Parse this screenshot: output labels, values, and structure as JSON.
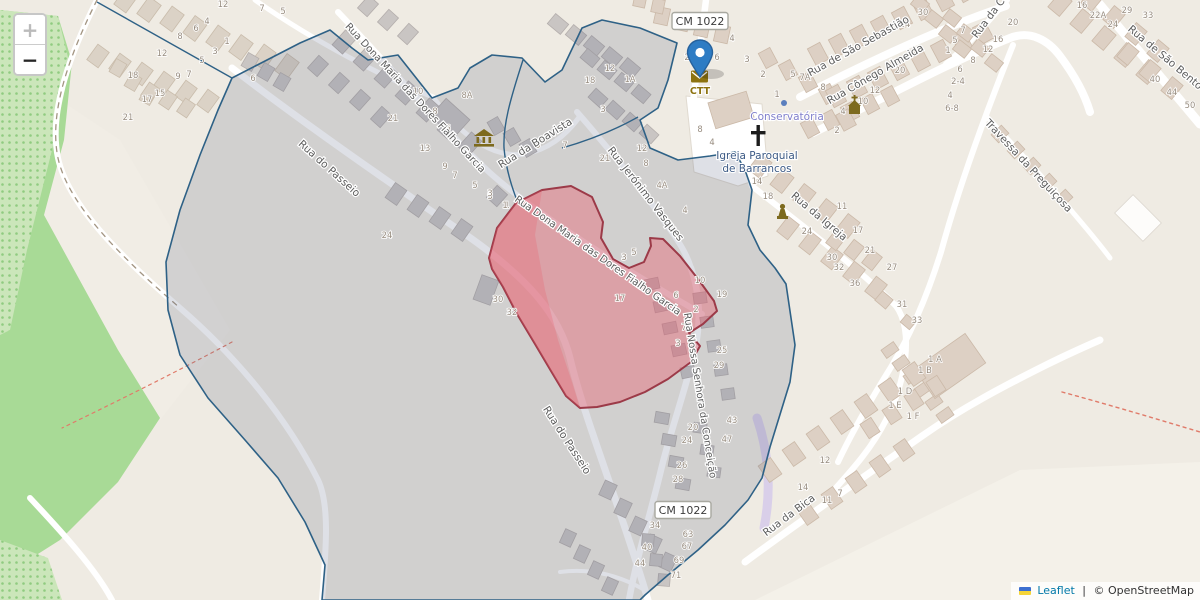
{
  "map_app": {
    "controls": {
      "zoom_in_label": "+",
      "zoom_out_label": "−"
    },
    "attribution": {
      "flag_icon": "ukraine-flag-icon",
      "leaflet_link": "Leaflet",
      "separator": " | ",
      "osm_credit": "© OpenStreetMap"
    },
    "marker": {
      "color": "#2e7cc4",
      "outline": "#26619c"
    },
    "overlay_colors": {
      "boundary_stroke": "#2e6186",
      "boundary_fill": "rgba(88,102,132,0.20)",
      "highlight_stroke": "#9c3a48",
      "highlight_fill": "rgba(233,96,112,0.42)"
    },
    "road_badges": [
      {
        "text": "CM 1022",
        "x": 700,
        "y": 21
      },
      {
        "text": "CM 1022",
        "x": 683,
        "y": 510
      }
    ],
    "pois": {
      "post_office": {
        "label": "CTT",
        "color": "#8d7310"
      },
      "conservatoria": {
        "label": "Conservatória",
        "color": "#8180cb"
      },
      "parish_church": {
        "label_line1": "Igreja Paroquial",
        "label_line2": "de Barrancos",
        "color": "#3c5a85"
      },
      "museum": {
        "icon": "museum-icon"
      },
      "chapel": {
        "icon": "chapel-icon"
      },
      "memorial": {
        "icon": "memorial-icon"
      }
    },
    "street_labels": [
      {
        "text": "Rua do Passeio",
        "x": 327,
        "y": 171,
        "rot": 42
      },
      {
        "text": "Rua do Passeio",
        "x": 564,
        "y": 442,
        "rot": 57
      },
      {
        "text": "Rua Dona Maria das Dores Fialho Garcia",
        "x": 413,
        "y": 100,
        "rot": 47,
        "fs": 10
      },
      {
        "text": "Rua Dona Maria das Dores Fialho Garcia",
        "x": 596,
        "y": 258,
        "rot": 35,
        "fs": 10
      },
      {
        "text": "Rua da Boavista",
        "x": 537,
        "y": 146,
        "rot": -32
      },
      {
        "text": "Rua Jerónimo Vasques",
        "x": 643,
        "y": 196,
        "rot": 52
      },
      {
        "text": "Rua Nossa Senhora da Conceição",
        "x": 697,
        "y": 396,
        "rot": 81,
        "fs": 10
      },
      {
        "text": "Rua de São Sebastião",
        "x": 860,
        "y": 49,
        "rot": -29
      },
      {
        "text": "Rua Cônego Almeida",
        "x": 877,
        "y": 77,
        "rot": -30
      },
      {
        "text": "Rua da Igreja",
        "x": 817,
        "y": 219,
        "rot": 40
      },
      {
        "text": "Travessa da Preguiçosa",
        "x": 1026,
        "y": 168,
        "rot": 47
      },
      {
        "text": "Rua de São Bento",
        "x": 1163,
        "y": 60,
        "rot": 40
      },
      {
        "text": "Rua da C",
        "x": 991,
        "y": 20,
        "rot": -53
      },
      {
        "text": "Rua da Bica",
        "x": 791,
        "y": 518,
        "rot": -37
      }
    ],
    "house_numbers": [
      {
        "t": "12",
        "x": 223,
        "y": 7
      },
      {
        "t": "7",
        "x": 262,
        "y": 11
      },
      {
        "t": "5",
        "x": 283,
        "y": 14
      },
      {
        "t": "4",
        "x": 207,
        "y": 24
      },
      {
        "t": "6",
        "x": 196,
        "y": 31
      },
      {
        "t": "8",
        "x": 180,
        "y": 39
      },
      {
        "t": "1",
        "x": 227,
        "y": 44
      },
      {
        "t": "3",
        "x": 215,
        "y": 54
      },
      {
        "t": "12",
        "x": 162,
        "y": 56
      },
      {
        "t": "5",
        "x": 202,
        "y": 63
      },
      {
        "t": "18",
        "x": 133,
        "y": 78
      },
      {
        "t": "9",
        "x": 178,
        "y": 79
      },
      {
        "t": "7",
        "x": 189,
        "y": 77
      },
      {
        "t": "17",
        "x": 147,
        "y": 102
      },
      {
        "t": "15",
        "x": 160,
        "y": 96
      },
      {
        "t": "21",
        "x": 128,
        "y": 120
      },
      {
        "t": "6",
        "x": 253,
        "y": 81
      },
      {
        "t": "24",
        "x": 387,
        "y": 238
      },
      {
        "t": "10",
        "x": 418,
        "y": 94
      },
      {
        "t": "8A",
        "x": 467,
        "y": 98
      },
      {
        "t": "8",
        "x": 435,
        "y": 114
      },
      {
        "t": "6",
        "x": 448,
        "y": 131
      },
      {
        "t": "21",
        "x": 393,
        "y": 121
      },
      {
        "t": "13",
        "x": 425,
        "y": 151
      },
      {
        "t": "9",
        "x": 445,
        "y": 169
      },
      {
        "t": "7",
        "x": 455,
        "y": 178
      },
      {
        "t": "5",
        "x": 475,
        "y": 188
      },
      {
        "t": "3",
        "x": 490,
        "y": 199
      },
      {
        "t": "1",
        "x": 507,
        "y": 208
      },
      {
        "t": "18",
        "x": 590,
        "y": 83
      },
      {
        "t": "9",
        "x": 538,
        "y": 148
      },
      {
        "t": "7",
        "x": 565,
        "y": 148
      },
      {
        "t": "12",
        "x": 610,
        "y": 71
      },
      {
        "t": "1A",
        "x": 630,
        "y": 82
      },
      {
        "t": "3",
        "x": 603,
        "y": 112
      },
      {
        "t": "21",
        "x": 605,
        "y": 161
      },
      {
        "t": "12",
        "x": 642,
        "y": 151
      },
      {
        "t": "8",
        "x": 646,
        "y": 166
      },
      {
        "t": "4A",
        "x": 662,
        "y": 188
      },
      {
        "t": "8",
        "x": 700,
        "y": 132
      },
      {
        "t": "4",
        "x": 712,
        "y": 145
      },
      {
        "t": "4",
        "x": 685,
        "y": 213
      },
      {
        "t": "2",
        "x": 687,
        "y": 60
      },
      {
        "t": "6",
        "x": 717,
        "y": 60
      },
      {
        "t": "4",
        "x": 732,
        "y": 41
      },
      {
        "t": "3",
        "x": 747,
        "y": 62
      },
      {
        "t": "2",
        "x": 763,
        "y": 77
      },
      {
        "t": "1",
        "x": 777,
        "y": 97
      },
      {
        "t": "5",
        "x": 793,
        "y": 77
      },
      {
        "t": "7A",
        "x": 805,
        "y": 80
      },
      {
        "t": "10",
        "x": 863,
        "y": 104
      },
      {
        "t": "4",
        "x": 843,
        "y": 114
      },
      {
        "t": "2",
        "x": 837,
        "y": 133
      },
      {
        "t": "11",
        "x": 842,
        "y": 209
      },
      {
        "t": "14",
        "x": 757,
        "y": 184
      },
      {
        "t": "18",
        "x": 768,
        "y": 199
      },
      {
        "t": "24",
        "x": 807,
        "y": 234
      },
      {
        "t": "24",
        "x": 905,
        "y": 27
      },
      {
        "t": "7",
        "x": 963,
        "y": 33
      },
      {
        "t": "5",
        "x": 955,
        "y": 43
      },
      {
        "t": "12",
        "x": 988,
        "y": 52
      },
      {
        "t": "8",
        "x": 973,
        "y": 63
      },
      {
        "t": "20",
        "x": 900,
        "y": 73
      },
      {
        "t": "12",
        "x": 875,
        "y": 93
      },
      {
        "t": "8",
        "x": 823,
        "y": 90
      },
      {
        "t": "6",
        "x": 960,
        "y": 72
      },
      {
        "t": "2-4",
        "x": 958,
        "y": 84
      },
      {
        "t": "4",
        "x": 950,
        "y": 98
      },
      {
        "t": "6-8",
        "x": 952,
        "y": 111
      },
      {
        "t": "30",
        "x": 923,
        "y": 15
      },
      {
        "t": "1",
        "x": 948,
        "y": 53
      },
      {
        "t": "20",
        "x": 1013,
        "y": 25
      },
      {
        "t": "16",
        "x": 998,
        "y": 42
      },
      {
        "t": "16",
        "x": 1082,
        "y": 8
      },
      {
        "t": "22A",
        "x": 1098,
        "y": 18
      },
      {
        "t": "29",
        "x": 1127,
        "y": 13
      },
      {
        "t": "24",
        "x": 1113,
        "y": 27
      },
      {
        "t": "33",
        "x": 1148,
        "y": 18
      },
      {
        "t": "40",
        "x": 1155,
        "y": 82
      },
      {
        "t": "44",
        "x": 1172,
        "y": 95
      },
      {
        "t": "50",
        "x": 1190,
        "y": 108
      },
      {
        "t": "17",
        "x": 858,
        "y": 233
      },
      {
        "t": "21",
        "x": 870,
        "y": 253
      },
      {
        "t": "30",
        "x": 832,
        "y": 260
      },
      {
        "t": "32",
        "x": 839,
        "y": 270
      },
      {
        "t": "27",
        "x": 892,
        "y": 270
      },
      {
        "t": "36",
        "x": 855,
        "y": 286
      },
      {
        "t": "31",
        "x": 902,
        "y": 307
      },
      {
        "t": "33",
        "x": 917,
        "y": 323
      },
      {
        "t": "1 A",
        "x": 935,
        "y": 362
      },
      {
        "t": "1 B",
        "x": 925,
        "y": 373
      },
      {
        "t": "1 D",
        "x": 905,
        "y": 394
      },
      {
        "t": "1 E",
        "x": 895,
        "y": 408
      },
      {
        "t": "1 F",
        "x": 913,
        "y": 419
      },
      {
        "t": "3",
        "x": 490,
        "y": 196
      },
      {
        "t": "1",
        "x": 505,
        "y": 208
      },
      {
        "t": "3",
        "x": 624,
        "y": 260
      },
      {
        "t": "5",
        "x": 634,
        "y": 255
      },
      {
        "t": "17",
        "x": 620,
        "y": 301
      },
      {
        "t": "6",
        "x": 676,
        "y": 298
      },
      {
        "t": "2",
        "x": 696,
        "y": 312
      },
      {
        "t": "7",
        "x": 684,
        "y": 330
      },
      {
        "t": "3",
        "x": 678,
        "y": 346
      },
      {
        "t": "10",
        "x": 700,
        "y": 283
      },
      {
        "t": "30",
        "x": 498,
        "y": 302
      },
      {
        "t": "32",
        "x": 512,
        "y": 315
      },
      {
        "t": "19",
        "x": 722,
        "y": 297
      },
      {
        "t": "25",
        "x": 722,
        "y": 353
      },
      {
        "t": "29",
        "x": 719,
        "y": 368
      },
      {
        "t": "43",
        "x": 732,
        "y": 423
      },
      {
        "t": "47",
        "x": 727,
        "y": 442
      },
      {
        "t": "20",
        "x": 693,
        "y": 430
      },
      {
        "t": "24",
        "x": 687,
        "y": 443
      },
      {
        "t": "26",
        "x": 682,
        "y": 468
      },
      {
        "t": "28",
        "x": 678,
        "y": 482
      },
      {
        "t": "34",
        "x": 655,
        "y": 528
      },
      {
        "t": "63",
        "x": 688,
        "y": 537
      },
      {
        "t": "40",
        "x": 647,
        "y": 550
      },
      {
        "t": "67",
        "x": 687,
        "y": 549
      },
      {
        "t": "44",
        "x": 640,
        "y": 566
      },
      {
        "t": "69",
        "x": 679,
        "y": 563
      },
      {
        "t": "71",
        "x": 676,
        "y": 578
      },
      {
        "t": "14",
        "x": 803,
        "y": 490
      },
      {
        "t": "11",
        "x": 827,
        "y": 503
      },
      {
        "t": "7",
        "x": 840,
        "y": 496
      },
      {
        "t": "12",
        "x": 825,
        "y": 463
      }
    ]
  }
}
